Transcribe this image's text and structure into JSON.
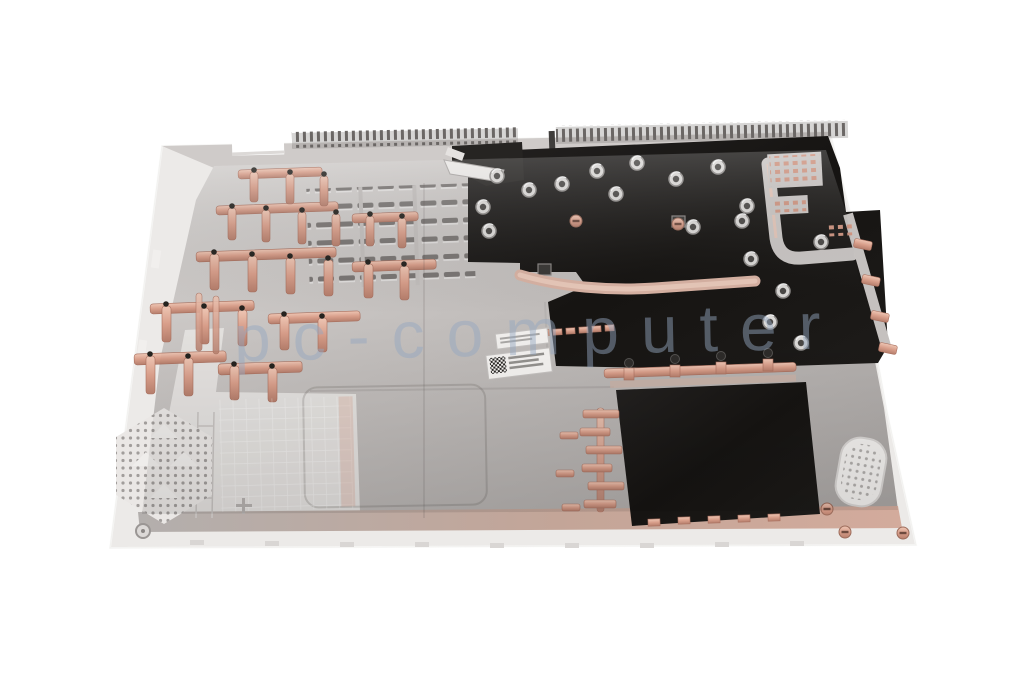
{
  "scene": {
    "type": "product-photo",
    "subject": "laptop bottom case, interior side, perspective view",
    "background_color": "#ffffff"
  },
  "watermark": {
    "text": "pc-computer",
    "color_rgba": "rgba(148,168,192,0.48)"
  },
  "palette": {
    "background": "#ffffff",
    "rim_white": "#eceae8",
    "metal_silver": "#c2bebc",
    "metal_light": "#d8d5d3",
    "metal_dark": "#a9a5a3",
    "plastic_white": "#e8e5e3",
    "copper": "#d89e8a",
    "copper_light": "#eec6b4",
    "copper_dark": "#b57e6c",
    "shield_black": "#1a1817",
    "watermark_color": "rgba(148,168,192,0.48)"
  },
  "stickers": {
    "count": 2,
    "note": "white service labels with unreadable micro-text, lower one carries a small QR code"
  },
  "parts": [
    "bottom-case-shell",
    "top-edge-vents",
    "cooling-vent-louvers",
    "copper-rib-lattice",
    "heat-pipe",
    "insulation-sheet-main",
    "battery-insulation-sheet",
    "screw-standoffs",
    "service-labels",
    "speaker-grille-left",
    "speaker-grille-right",
    "watermark"
  ]
}
